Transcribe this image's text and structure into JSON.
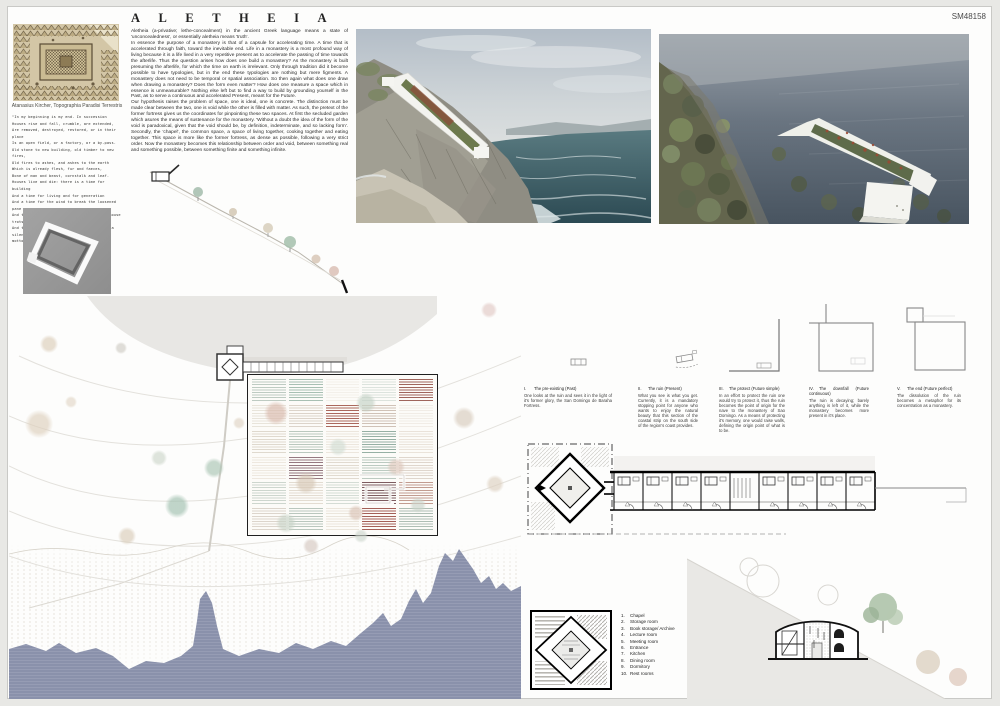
{
  "board_id": "SM48158",
  "title": "ALETHEIA",
  "essay": {
    "intro": "Aletheia (a-privative; lethe-concealment) in the ancient Greek language means a state of 'unconcealedness', or essentially aletheia means 'truth'.",
    "p1": "In essence the purpose of a monastery is that of a capsule for accelerating time. A time that is accelerated through faith, toward the inevitable end. Life in a monastery is a most profound way of living because it is a life lived in a very repetitive present as to accelerate the passing of time towards the afterlife. Thus the question arises how does one build a monastery? As the monastery is built presuming the afterlife, for which the time on earth is irrelevant. Only through tradition did it become possible to have typologies, but in the end these typologies are nothing but mere figments. A monastery does not need to be temporal or spatial association. So then again what does one draw when drawing a monastery? Does the form even matter? How does one measure a space which in essence is unmeasurable? Nothing else left but to find a way to build by grounding yourself in the Past, as to serve a continuous and accelerated Present, meant for the Future.",
    "p2": "Our hypothesis raises the problem of space, one is ideal, one is concrete. The distinction must be made clear between the two, one is void while the other is filled with matter. As such, the pretext of the former fortress gives us the coordinates for pinpointing these two spaces. At first the secluded garden which asures the means of sustenance for the monastery. 'Without a doubt the idea of the form of the void is paradoxical, given that the void should be, by definition, indeterminate, and so lacking form'. Secondly, the 'chapel', the common space, a space of living together, cooking together and eating together. This space is more like the former fortress, as dense as possible, following a very strict order. Now the monastery becomes this relationship between order and void, between something real and something possible, between something finite and something infinite."
  },
  "engraving_caption": "Atanasius Kircher, Topographia Paradisi Terrestris",
  "quote": "\"In my beginning is my end. In succession\nHouses rise and fall, crumble, are extended,\nAre removed, destroyed, restored, or in their place\nIs an open field, or a factory, or a by-pass.\nOld stone to new building, old timber to new fires,\nOld fires to ashes, and ashes to the earth\nWhich is already flesh, fur and faeces,\nBone of man and beast, cornstalk and leaf.\nHouses live and die: there is a time for building\nAnd a time for living and for generation\nAnd a time for the wind to break the loosened pane\nAnd to shake the wainscot where the field-mouse trots\nAnd to shake the tattered arras woven with a silent\nmotto.\" (T.S. Eliot, Four Quartets)",
  "diagrams": [
    {
      "numeral": "I.",
      "title": "The pre-existing (Past)",
      "body": "One looks at the ruin and sees it in the light of it's former glory, the San Domingo de Baraha Fortress."
    },
    {
      "numeral": "II.",
      "title": "The ruin (Present)",
      "body": "What you see is what you get. Currently, it is a mandatory stopping point for anyone who wants to enjoy the natural beauty that this section of the coastal strip on the south side of the region's coast provides."
    },
    {
      "numeral": "III.",
      "title": "The protect (Future simple)",
      "body": "In an effort to protect the ruin one would try to protect it, thus the ruin becomes the point of origin for the nave to the monastery of Sao Domingo. As a means of protecting it's memory, one would raise walls, defining the origin point of what is to be."
    },
    {
      "numeral": "IV.",
      "title": "The downfall (Future continuous)",
      "body": "The ruin is decaying; barely anything is left of it, while the monastery becomes more present in it's place."
    },
    {
      "numeral": "V.",
      "title": "The end (Future perfect)",
      "body": "The dissolution of the ruin becomes a metaphor for its concentration as a monastery."
    }
  ],
  "legend": {
    "items": [
      "Chapel",
      "Storage room",
      "Book storage/ Archive",
      "Lecture room",
      "Meeting room",
      "Entrance",
      "Kitchen",
      "Dining room",
      "Dormitory",
      "Rest rooms"
    ]
  },
  "site_plan": {
    "sea_color": "#8a91ab",
    "garden": {
      "patches": [
        "#b7c6bc",
        "#9fb9ab",
        "#f2efe9",
        "#d9e0da",
        "#96544b",
        "#e6e1d7",
        "#d9d0c5",
        "#a2584c",
        "#cbbcb0",
        "#f0ebe4",
        "#dcd5c9",
        "#b2c3b8",
        "#eae4da",
        "#8aa79a",
        "#e8e0d6",
        "#ece6dc",
        "#8a6a73",
        "#ded7cc",
        "#b5c5bb",
        "#dcd2c8",
        "#c8d2c9",
        "#e0d8cd",
        "#cfd9d1",
        "#6f4b4f",
        "#bb9184",
        "#d8d1c7",
        "#b3c1b7",
        "#e9e3d9",
        "#9a4e45",
        "#a6b7ac"
      ],
      "trees": [
        {
          "x": 28,
          "y": 38,
          "r": 12,
          "c": "#d9b9ac"
        },
        {
          "x": 118,
          "y": 28,
          "r": 10,
          "c": "#c3d1c5"
        },
        {
          "x": 58,
          "y": 108,
          "r": 11,
          "c": "#d6c7b5"
        },
        {
          "x": 148,
          "y": 92,
          "r": 9,
          "c": "#ddc7bb"
        },
        {
          "x": 38,
          "y": 148,
          "r": 10,
          "c": "#c8d3c7"
        },
        {
          "x": 108,
          "y": 138,
          "r": 8,
          "c": "#dac3b6"
        },
        {
          "x": 170,
          "y": 130,
          "r": 8,
          "c": "#cbd5cb"
        },
        {
          "x": 90,
          "y": 72,
          "r": 9,
          "c": "#d2ddd4"
        }
      ]
    },
    "trees": [
      {
        "x": 40,
        "y": 48,
        "r": 9,
        "c": "#dbcdb9"
      },
      {
        "x": 112,
        "y": 52,
        "r": 6,
        "c": "#cfccc4"
      },
      {
        "x": 30,
        "y": 128,
        "r": 14,
        "c": "#ddcfbc"
      },
      {
        "x": 62,
        "y": 106,
        "r": 6,
        "c": "#e2d7c7"
      },
      {
        "x": 150,
        "y": 162,
        "r": 8,
        "c": "#cdd6ca"
      },
      {
        "x": 205,
        "y": 172,
        "r": 10,
        "c": "#a9c4b3"
      },
      {
        "x": 168,
        "y": 210,
        "r": 12,
        "c": "#9fbfae"
      },
      {
        "x": 118,
        "y": 240,
        "r": 9,
        "c": "#d9ccb9"
      },
      {
        "x": 230,
        "y": 127,
        "r": 6,
        "c": "#dfd4c4"
      },
      {
        "x": 455,
        "y": 122,
        "r": 11,
        "c": "#d7cbbc"
      },
      {
        "x": 480,
        "y": 14,
        "r": 8,
        "c": "#e1c9c5"
      },
      {
        "x": 486,
        "y": 188,
        "r": 9,
        "c": "#ddd0c0"
      },
      {
        "x": 302,
        "y": 250,
        "r": 8,
        "c": "#d5c8c0"
      },
      {
        "x": 352,
        "y": 240,
        "r": 7,
        "c": "#cfd8cf"
      }
    ]
  }
}
